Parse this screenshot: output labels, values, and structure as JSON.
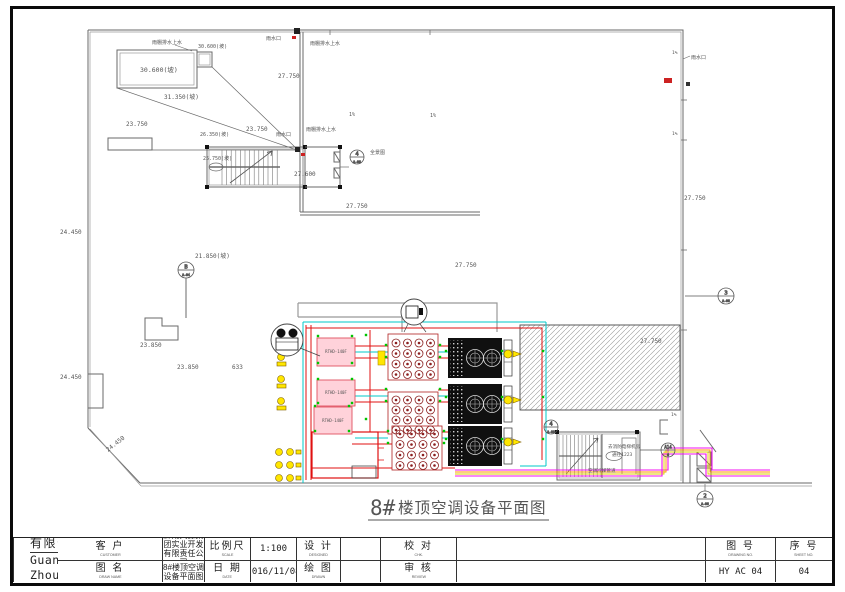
{
  "sheet": {
    "title_prefix": "8#",
    "title_rest": "楼顶空调设备平面图"
  },
  "title_block": {
    "customer_label": "客 户",
    "customer_sub": "CUSTOMER",
    "customer_value_line1": "黔南天源集团实业开发",
    "customer_value_line2": "有限责任公司",
    "drawname_label": "图 名",
    "drawname_sub": "DRAW NAME",
    "drawname_value": "8#楼顶空调设备平面图",
    "scale_label": "比例尺",
    "scale_sub": "SCALE",
    "scale_value": "1:100",
    "date_label": "日 期",
    "date_sub": "DATE",
    "date_value": "2016/11/08",
    "design_label": "设 计",
    "design_sub": "DESIGNED",
    "design_value": "",
    "drawn_label": "绘 图",
    "drawn_sub": "DRAWN",
    "drawn_value": "",
    "check_label": "校 对",
    "check_sub": "CHK.",
    "check_value": "",
    "review_label": "审 核",
    "review_sub": "REVIEW",
    "review_value": "",
    "company_cn": "H' STAR 广州恒雅空调工程有限公司",
    "company_en": "Guang ZhouHengya Air Conditioning",
    "logo_text": "HY",
    "drawing_no_label": "图 号",
    "drawing_no_sub": "DRAWING NO.",
    "drawing_no_value": "HY AC 04",
    "sheet_no_label": "序 号",
    "sheet_no_sub": "SHEET NO.",
    "sheet_no_value": "04"
  },
  "plan": {
    "labels": [
      "雨棚排水上水",
      "30.600(坡)",
      "30.600(坡)",
      "31.350(坡)",
      "23.750",
      "雨水口",
      "雨棚排水上水",
      "27.750",
      "23.750",
      "26.350(坡)",
      "25.750(坡)",
      "雨水口",
      "雨棚排水上水",
      "27.600",
      "全景图",
      "1%",
      "1%",
      "27.750",
      "27.750",
      "21.850(坡)",
      "24.450",
      "23.850",
      "23.850",
      "633",
      "24.450",
      "24.450",
      "雨水口",
      "27.750",
      "27.750",
      "去消防电梯机房",
      "通往1223",
      "空调冷媒管道",
      "1%",
      "1%",
      "1%"
    ],
    "callouts": [
      {
        "num": "4",
        "sub": "A-06"
      },
      {
        "num": "B",
        "sub": "A-04"
      },
      {
        "num": "3",
        "sub": "A-06"
      },
      {
        "num": "4",
        "sub": "A-06"
      },
      {
        "num": "A14",
        "sub": "6"
      },
      {
        "num": "2",
        "sub": "A-06"
      }
    ],
    "unit_label": "RTHD-140F"
  },
  "colors": {
    "pipe_red": "#e01010",
    "pipe_cyan": "#00c8c8",
    "pipe_magenta": "#f010f0",
    "pipe_orange": "#ff9900",
    "valve_yellow": "#ffe600",
    "node_green": "#00c400",
    "condenser_ring": "#8b1f1f",
    "linework": "#5a5a5a",
    "logo_red": "#a03010",
    "logo_blue": "#1a35c8",
    "logo_green": "#1f9e1f"
  }
}
